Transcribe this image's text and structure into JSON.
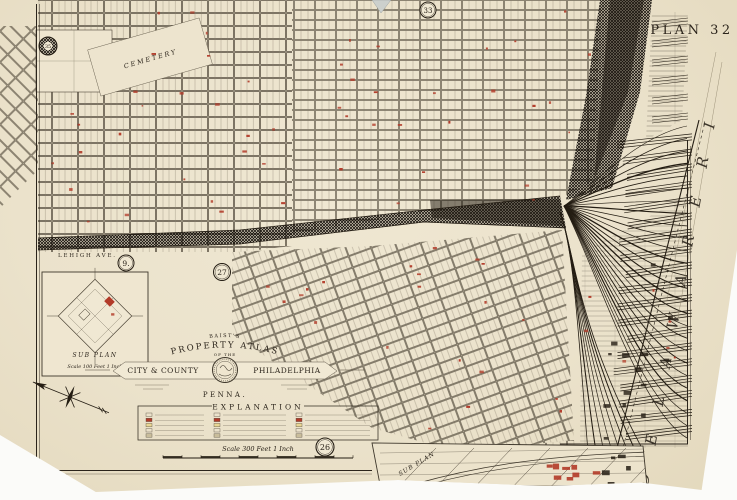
{
  "plate": {
    "label": "PLAN 32"
  },
  "river": {
    "label": "D E L A W A R E    R I V E R"
  },
  "plate_circles": [
    {
      "label": "35"
    },
    {
      "label": "9."
    },
    {
      "label": "27"
    },
    {
      "label": "33"
    },
    {
      "label": "26"
    }
  ],
  "street_labels": {
    "lehigh": "LEHIGH AVE.",
    "cemetery": "CEMETERY",
    "canal": "CANAL"
  },
  "cartouche": {
    "series": "BAIST'S",
    "title_arc": "PROPERTY ATLAS",
    "of_the": "OF THE",
    "banner_left": "CITY & COUNTY",
    "banner_right": "PHILADELPHIA",
    "state": "PENNA."
  },
  "legend": {
    "title": "EXPLANATION",
    "scale_text": "Scale 300 Feet 1 Inch"
  },
  "inset_left": {
    "title": "SUB PLAN",
    "scale_text": "Scale 100 Feet 1 Inch"
  },
  "inset_bottom_right": {
    "title": "SUB PLAN"
  },
  "colors": {
    "paper": "#ebe2cb",
    "ink": "#2b241b",
    "building_red": "#b23a28",
    "legend_title_red": "#96402e",
    "river_text": "#4a433a"
  }
}
